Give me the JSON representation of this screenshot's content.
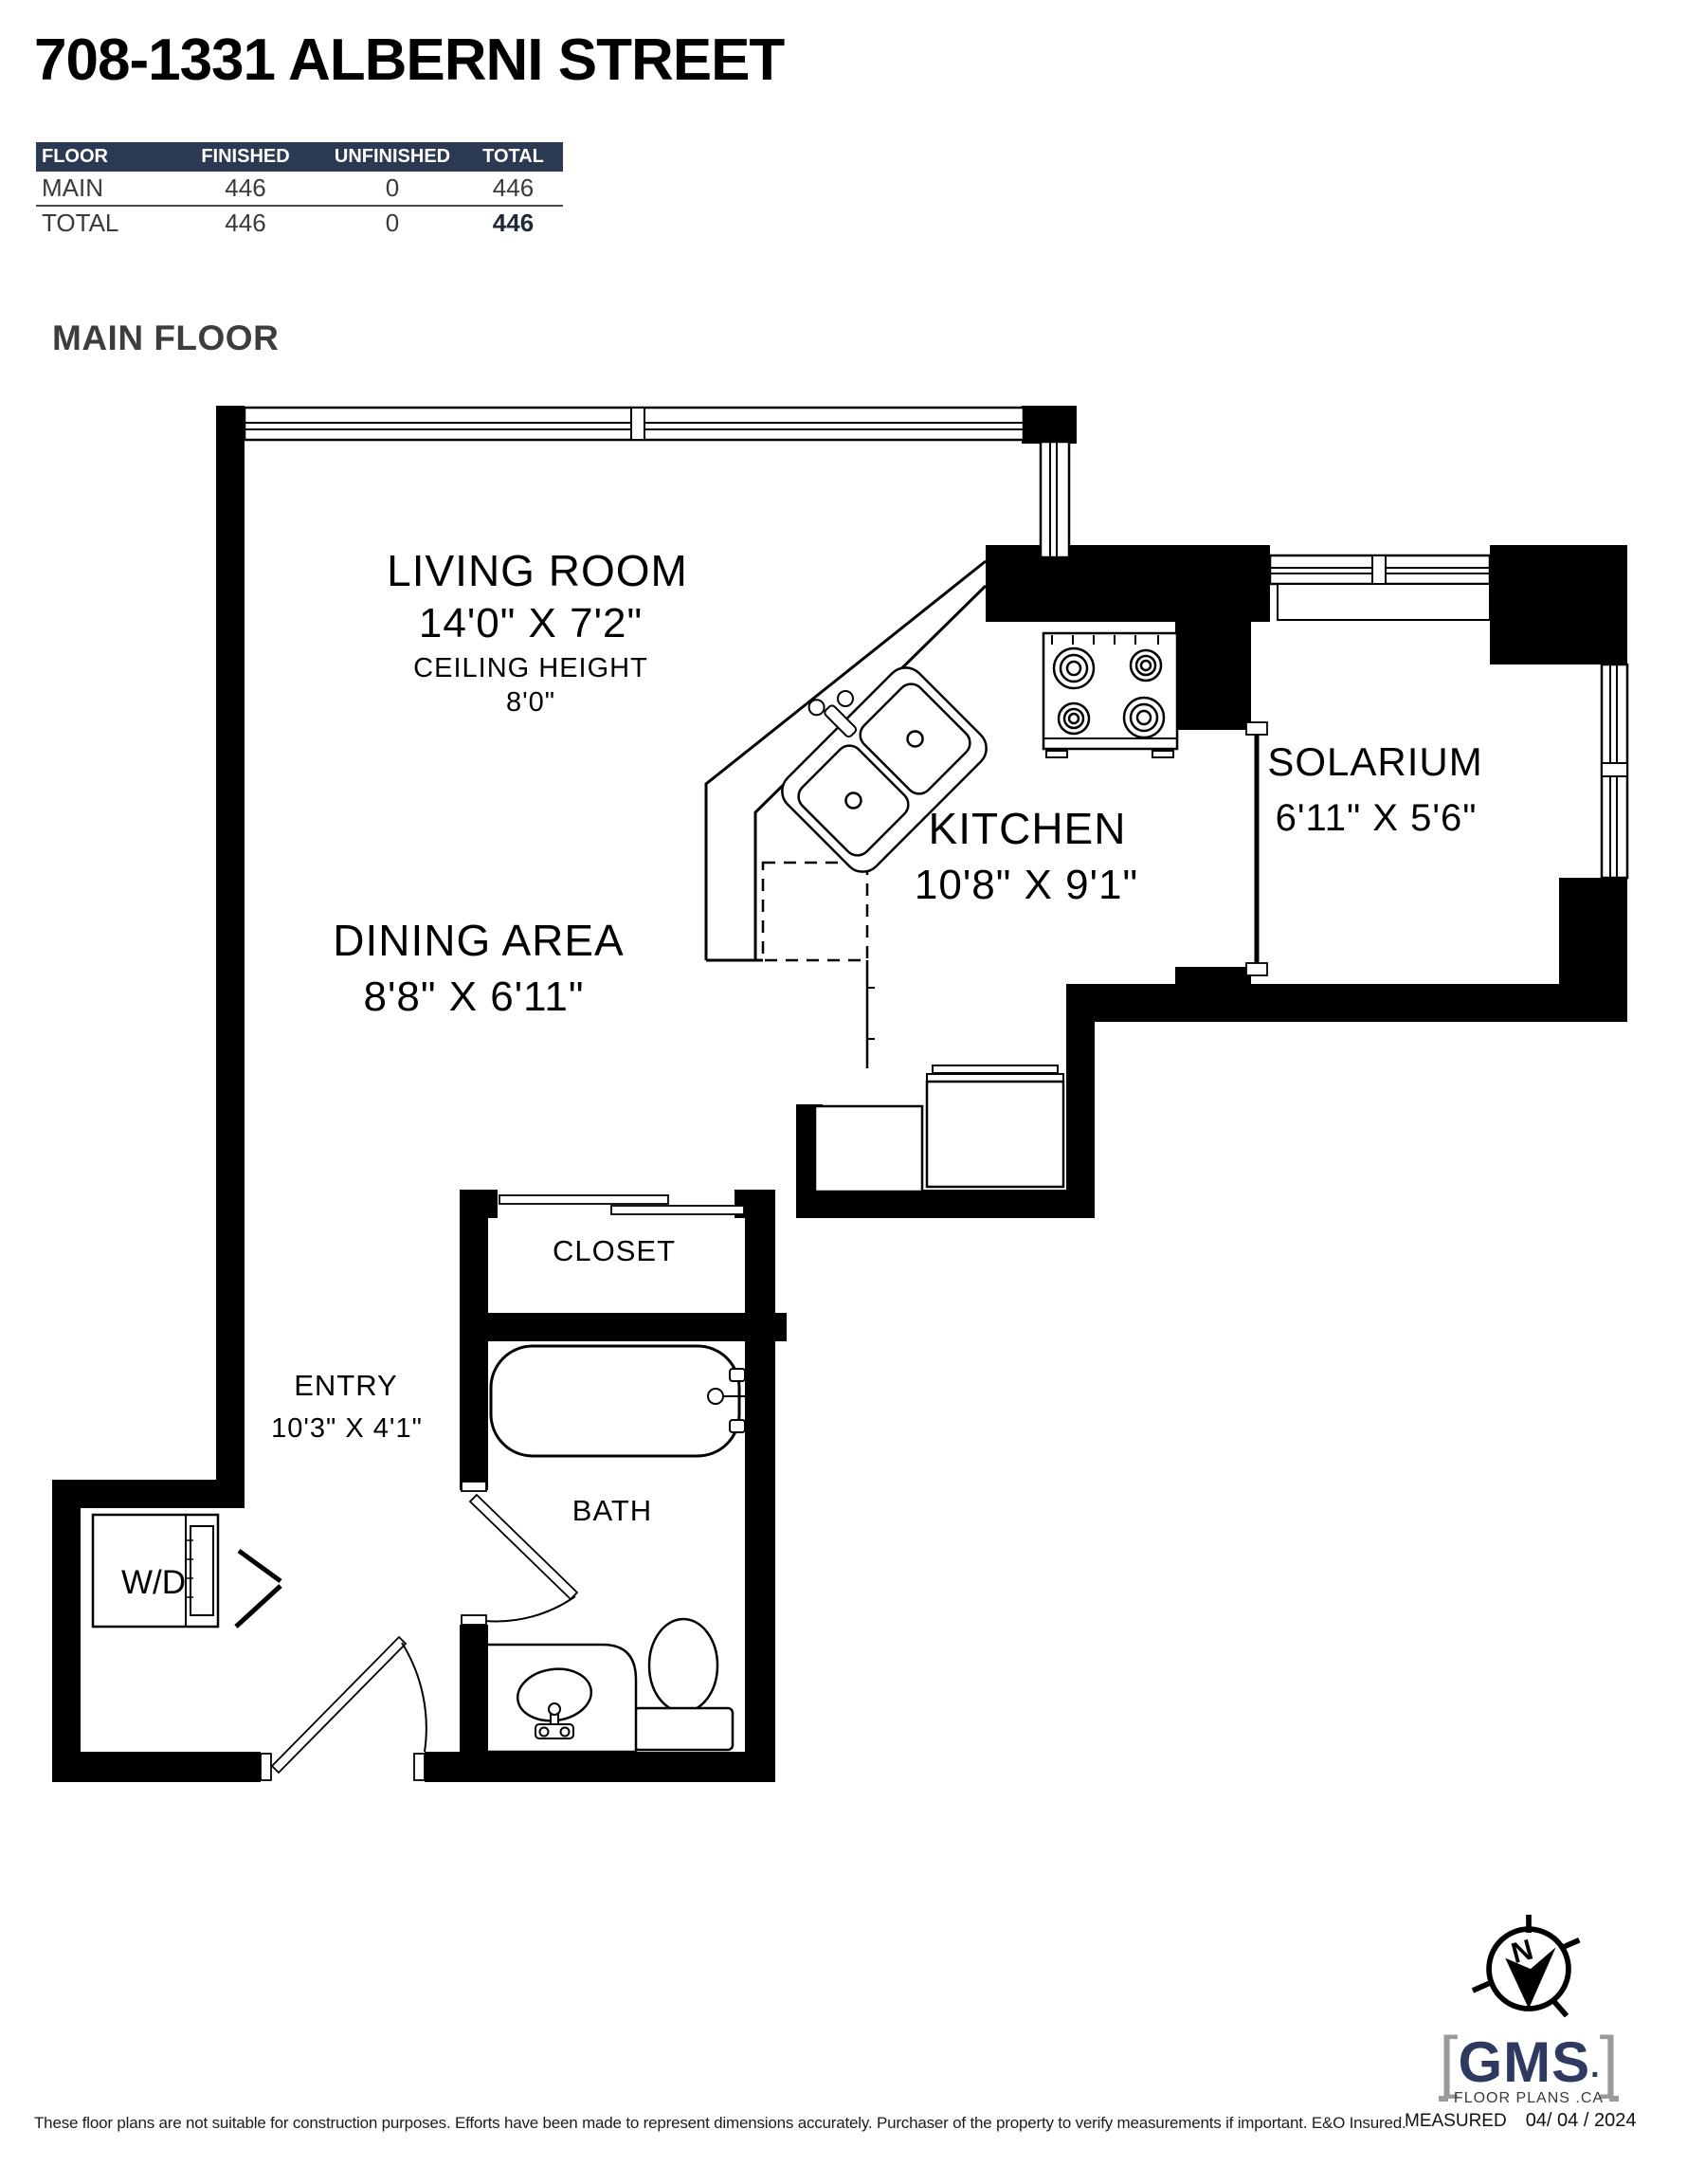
{
  "header": {
    "title": "708-1331 ALBERNI STREET"
  },
  "area_table": {
    "columns": [
      "FLOOR",
      "FINISHED",
      "UNFINISHED",
      "TOTAL"
    ],
    "rows": [
      {
        "floor": "MAIN",
        "finished": "446",
        "unfinished": "0",
        "total": "446"
      },
      {
        "floor": "TOTAL",
        "finished": "446",
        "unfinished": "0",
        "total": "446"
      }
    ]
  },
  "floor_label": "MAIN FLOOR",
  "rooms": {
    "living_room": {
      "name": "LIVING ROOM",
      "dimensions": "14'0\" X 7'2\"",
      "ceiling_label": "CEILING HEIGHT",
      "ceiling_value": "8'0\""
    },
    "dining_area": {
      "name": "DINING AREA",
      "dimensions": "8'8\" X 6'11\""
    },
    "kitchen": {
      "name": "KITCHEN",
      "dimensions": "10'8\" X 9'1\""
    },
    "solarium": {
      "name": "SOLARIUM",
      "dimensions": "6'11\" X 5'6\""
    },
    "closet": {
      "name": "CLOSET"
    },
    "entry": {
      "name": "ENTRY",
      "dimensions": "10'3\" X 4'1\""
    },
    "bath": {
      "name": "BATH"
    },
    "washer_dryer": {
      "name": "W/D"
    }
  },
  "footer": {
    "disclaimer": "These floor plans are not suitable for construction purposes. Efforts have been made to represent dimensions accurately.  Purchaser of the property to verify measurements if important.  E&O Insured.",
    "measured_label": "MEASURED",
    "measured_date": "04/ 04 / 2024"
  },
  "logo": {
    "compass_letter": "N",
    "bracket_left": "[",
    "text": "GMS",
    "dot": ".",
    "bracket_right": "]",
    "tagline": "FLOOR PLANS .CA"
  },
  "colors": {
    "wall": "#000000",
    "table_header_bg": "#2b3a52",
    "logo_navy": "#2e3a5f",
    "logo_gray": "#9a9a9a"
  }
}
